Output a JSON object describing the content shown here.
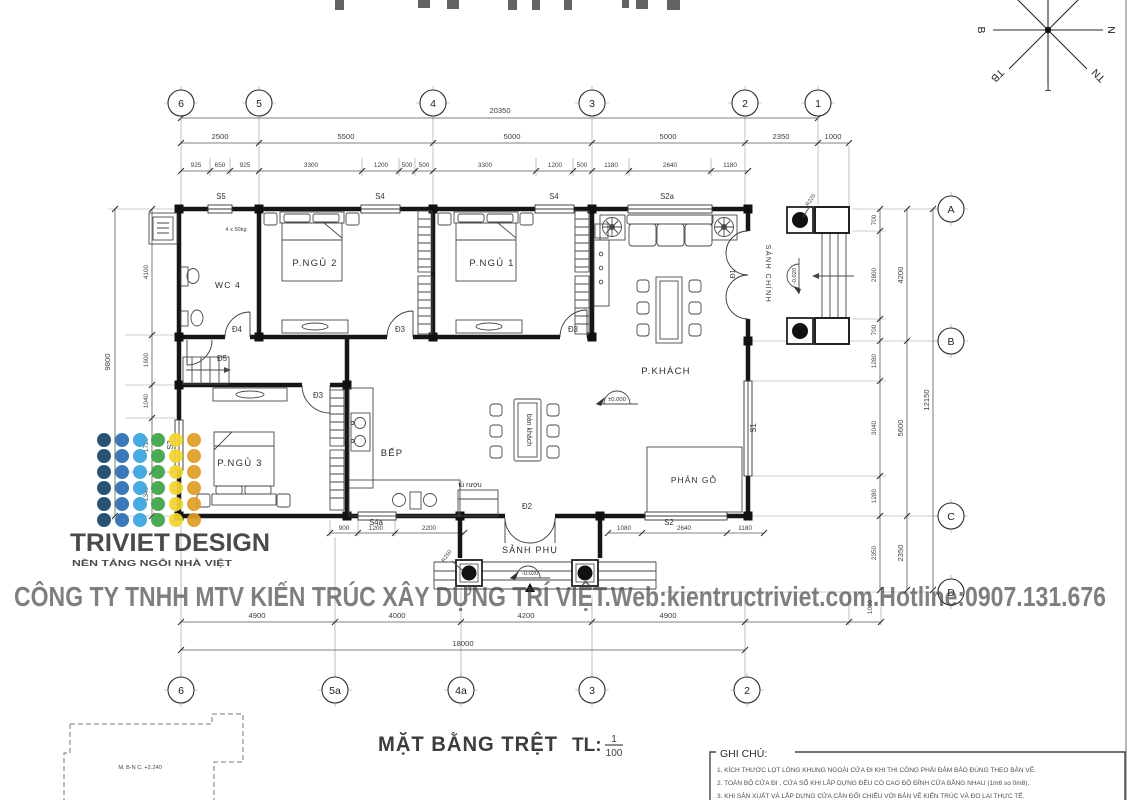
{
  "title": {
    "main": "MẶT BẰNG TRỆT",
    "scale_label": "TL:",
    "scale_num": "1",
    "scale_den": "100"
  },
  "watermark": {
    "text": "CÔNG TY TNHH MTV KIẾN TRÚC XÂY DỰNG TRÍ VIỆT.Web:kientructriviet.com.Hotline:0907.131.676",
    "color": "#b7b7b7"
  },
  "logo": {
    "brand_1": "TRIVIET",
    "brand_2": "DESIGN",
    "tagline": "NỀN TẢNG NGÔI NHÀ VIỆT",
    "brand1_color": "#e8898d",
    "brand2_color": "#b9d4ec",
    "tagline_color": "#15385e",
    "dot_colors": [
      "#1d4569",
      "#2f6eb3",
      "#3ba4dc",
      "#3fa448",
      "#f2d630",
      "#de9e28"
    ]
  },
  "grid": {
    "top": [
      "6",
      "5",
      "4",
      "3",
      "2",
      "1"
    ],
    "bottom": [
      "6",
      "5a",
      "4a",
      "3",
      "2"
    ],
    "right": [
      "A",
      "B",
      "C",
      "D"
    ]
  },
  "dims": {
    "top1": "20350",
    "top2": [
      "2500",
      "5500",
      "5000",
      "5000",
      "2350",
      "1000"
    ],
    "top3": [
      "925",
      "650",
      "925",
      "3300",
      "1200",
      "500",
      "500",
      "3300",
      "1200",
      "500",
      "1180",
      "2640",
      "1180"
    ],
    "left1": "9800",
    "left2": [
      "4100",
      "1600",
      "1040",
      "1720",
      "1340"
    ],
    "right1": [
      "700",
      "2800",
      "700",
      "1280",
      "3040",
      "1280",
      "2350"
    ],
    "right2": [
      "4200",
      "5600",
      "2350"
    ],
    "right3": "12150",
    "bottom_sub": [
      "900",
      "1200",
      "2200",
      "1080",
      "2640",
      "1180"
    ],
    "bottom1": [
      "4900",
      "4000",
      "4200",
      "4900"
    ],
    "bottom1b": "1000",
    "bottom2": "18000"
  },
  "rooms": {
    "wc": "WC 4",
    "bed2": "P.NGỦ 2",
    "bed1": "P.NGỦ 1",
    "bed3": "P.NGỦ 3",
    "kitchen": "BẾP",
    "living": "P.KHÁCH",
    "platform": "PHẢN GỖ",
    "porch_side": "SẢNH PHỤ",
    "porch_main": "SẢNH CHÍNH",
    "table": "bàn khách",
    "wine": "tủ rượu"
  },
  "doors": {
    "d1": "Đ1",
    "d2": "Đ2",
    "d3": "Đ3",
    "d4": "Đ4",
    "d5": "Đ5"
  },
  "windows": {
    "s1": "S1",
    "s2": "S2",
    "s2a": "S2a",
    "s3": "S3",
    "s4": "S4",
    "s4a": "S4a",
    "s5": "S5"
  },
  "levels": {
    "zero": "±0.000",
    "minus020": "-0.020"
  },
  "annotations": {
    "r220": "R220",
    "r250": "R250",
    "wc_note": "4 x 50kg",
    "site_note": "M. B-N C. +2.240"
  },
  "compass": {
    "e": "N",
    "w": "B",
    "s": "T",
    "sw": "TB",
    "se": "TN",
    "n": "Đ",
    "ne": "ĐN",
    "nw": "ĐB"
  },
  "notes": {
    "title": "GHI CHÚ:",
    "n1": "1. KÍCH THƯỚC LỌT LÒNG KHUNG NGOÀI CỬA ĐI KHI THI CÔNG PHẢI ĐẢM BẢO ĐÚNG THEO BẢN VẼ.",
    "n2": "2. TOÀN BỘ CỬA ĐI , CỬA SỔ KHI LẮP DỰNG ĐỀU CÓ CAO ĐỘ ĐỈNH CỬA BẰNG NHAU (1m6 so 0m8).",
    "n3": "3. KHI SẢN XUẤT VÀ LẮP DỰNG CỬA CẦN ĐỐI CHIẾU VỚI BẢN VẼ KIẾN TRÚC VÀ ĐO LẠI THỰC TẾ."
  }
}
